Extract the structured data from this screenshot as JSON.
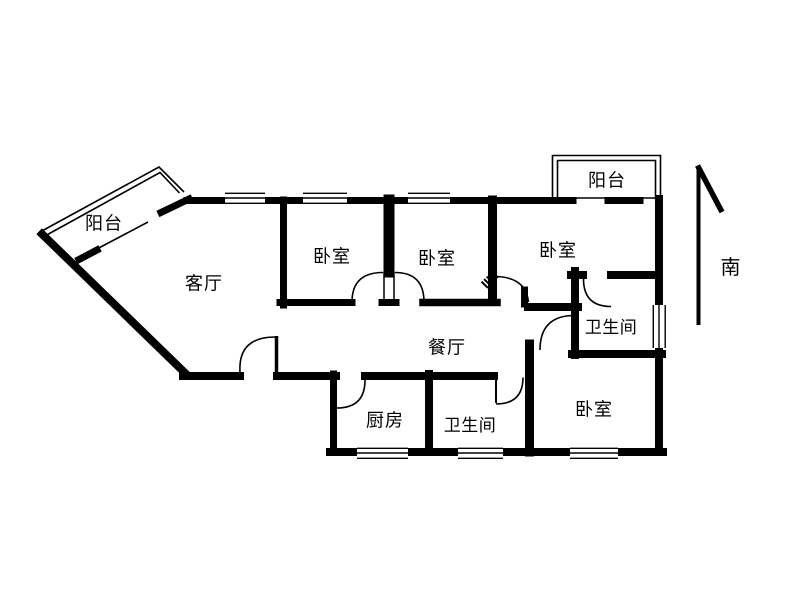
{
  "colors": {
    "wall": "#000000",
    "background": "#ffffff",
    "text": "#000000"
  },
  "compass": {
    "direction_label": "南"
  },
  "rooms": {
    "balcony_top_left": {
      "label": "阳台"
    },
    "living_room": {
      "label": "客厅"
    },
    "bedroom_1": {
      "label": "卧室"
    },
    "bedroom_2": {
      "label": "卧室"
    },
    "bedroom_3": {
      "label": "卧室"
    },
    "balcony_top_right": {
      "label": "阳台"
    },
    "bathroom_1": {
      "label": "卫生间"
    },
    "dining_room": {
      "label": "餐厅"
    },
    "kitchen": {
      "label": "厨房"
    },
    "bathroom_2": {
      "label": "卫生间"
    },
    "bedroom_4": {
      "label": "卧室"
    }
  }
}
